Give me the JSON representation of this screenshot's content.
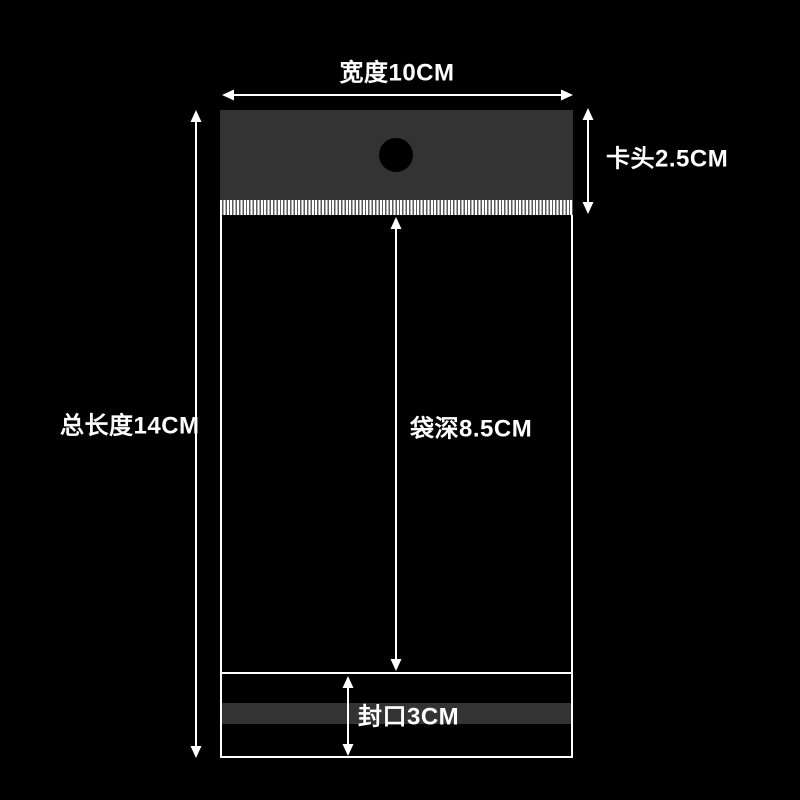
{
  "labels": {
    "width": "宽度10CM",
    "header_clip": "卡头2.5CM",
    "total_length": "总长度14CM",
    "bag_depth": "袋深8.5CM",
    "seal": "封口3CM"
  },
  "dimensions_cm": {
    "width": 10,
    "header_clip": 2.5,
    "total_length": 14,
    "bag_depth": 8.5,
    "seal": 3
  },
  "colors": {
    "background": "#000000",
    "bag_header_fill": "#333333",
    "seal_band_fill": "#333333",
    "outline": "#ffffff",
    "text": "#ffffff",
    "hang_hole_fill": "#000000",
    "stripe_gap": "#5a5a5a"
  }
}
